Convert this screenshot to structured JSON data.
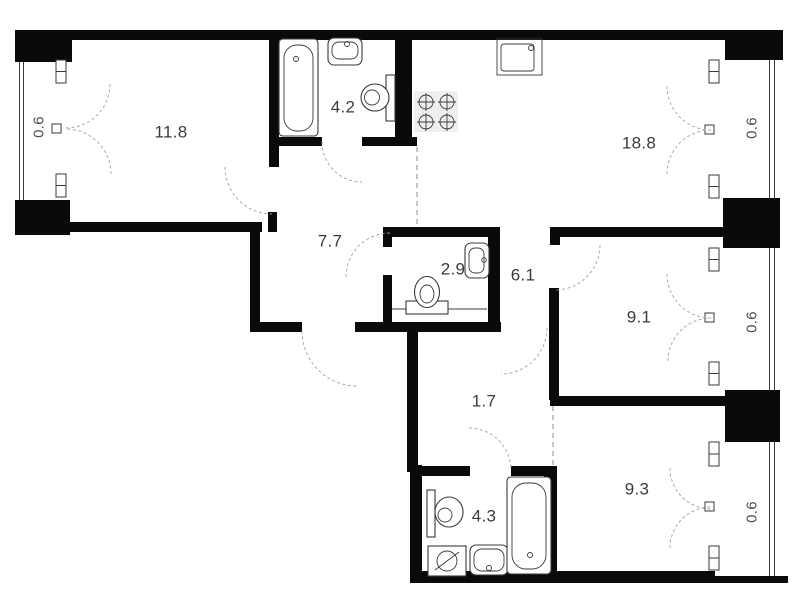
{
  "colors": {
    "wall": "#0a0a0a",
    "line": "#3a3a3a",
    "door": "#a3a3a3",
    "label": "#3a3a3a",
    "balcony-label": "#4d4d4d",
    "bg": "#ffffff"
  },
  "rooms": [
    {
      "name": "room",
      "area": "11.8"
    },
    {
      "name": "bathroom",
      "area": "4.2"
    },
    {
      "name": "kitchen-living",
      "area": "18.8"
    },
    {
      "name": "hallway",
      "area": "7.7"
    },
    {
      "name": "wc",
      "area": "2.9"
    },
    {
      "name": "corridor",
      "area": "6.1"
    },
    {
      "name": "bedroom",
      "area": "9.1"
    },
    {
      "name": "corridor-small",
      "area": "1.7"
    },
    {
      "name": "bedroom-2",
      "area": "9.3"
    },
    {
      "name": "bathroom-2",
      "area": "4.3"
    }
  ],
  "balconies": [
    {
      "name": "balcony-left",
      "area": "0.6"
    },
    {
      "name": "balcony-right-top",
      "area": "0.6"
    },
    {
      "name": "balcony-right-middle",
      "area": "0.6"
    },
    {
      "name": "balcony-right-bottom",
      "area": "0.6"
    }
  ]
}
